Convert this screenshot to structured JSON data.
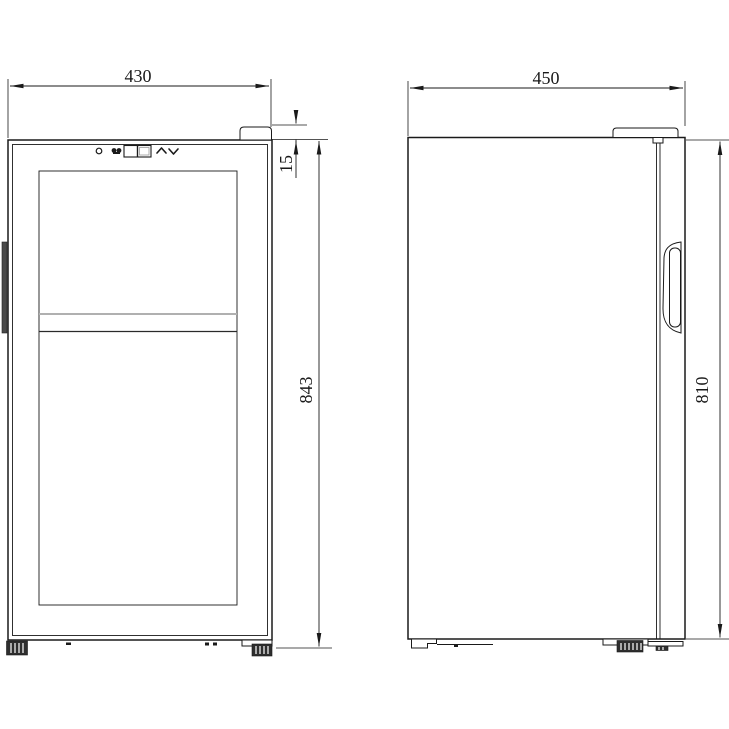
{
  "diagram": {
    "background_color": "#ffffff",
    "line_color": "#1a1a1a",
    "front_view": {
      "dimensions": {
        "width": "430",
        "hinge_height": "15",
        "overall_height": "843"
      },
      "control_panel_icons": [
        "power-icon",
        "light-icon",
        "temperature-display",
        "chevron-up-icon",
        "chevron-down-icon"
      ]
    },
    "side_view": {
      "dimensions": {
        "depth": "450",
        "body_height": "810"
      }
    }
  }
}
